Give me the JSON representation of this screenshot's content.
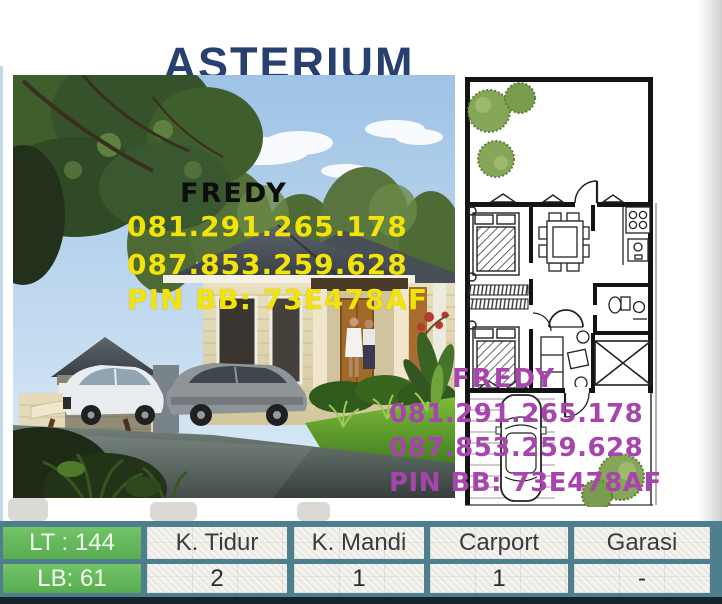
{
  "title": "ASTERIUM",
  "photo_overlay": {
    "agent": "FREDY",
    "phone1": "081.291.265.178",
    "phone2": "087.853.259.628",
    "pin": "PIN BB: 73E478AF"
  },
  "plan_overlay": {
    "agent": "FREDY",
    "phone1": "081.291.265.178",
    "phone2": "087.853.259.628",
    "pin": "PIN BB: 73E478AF"
  },
  "spec_table": {
    "lt_label": "LT : 144",
    "lb_label": "LB: 61",
    "columns": [
      {
        "header": "K. Tidur",
        "value": "2"
      },
      {
        "header": "K. Mandi",
        "value": "1"
      },
      {
        "header": "Carport",
        "value": "1"
      },
      {
        "header": "Garasi",
        "value": "-"
      }
    ]
  },
  "colors": {
    "title_navy": "#27406f",
    "phone_yellow": "#f2e30a",
    "phone_purple": "#a844ae",
    "table_green": "#63b75b",
    "table_teal": "#4e7f8f",
    "cell_gray": "#eceae5"
  }
}
